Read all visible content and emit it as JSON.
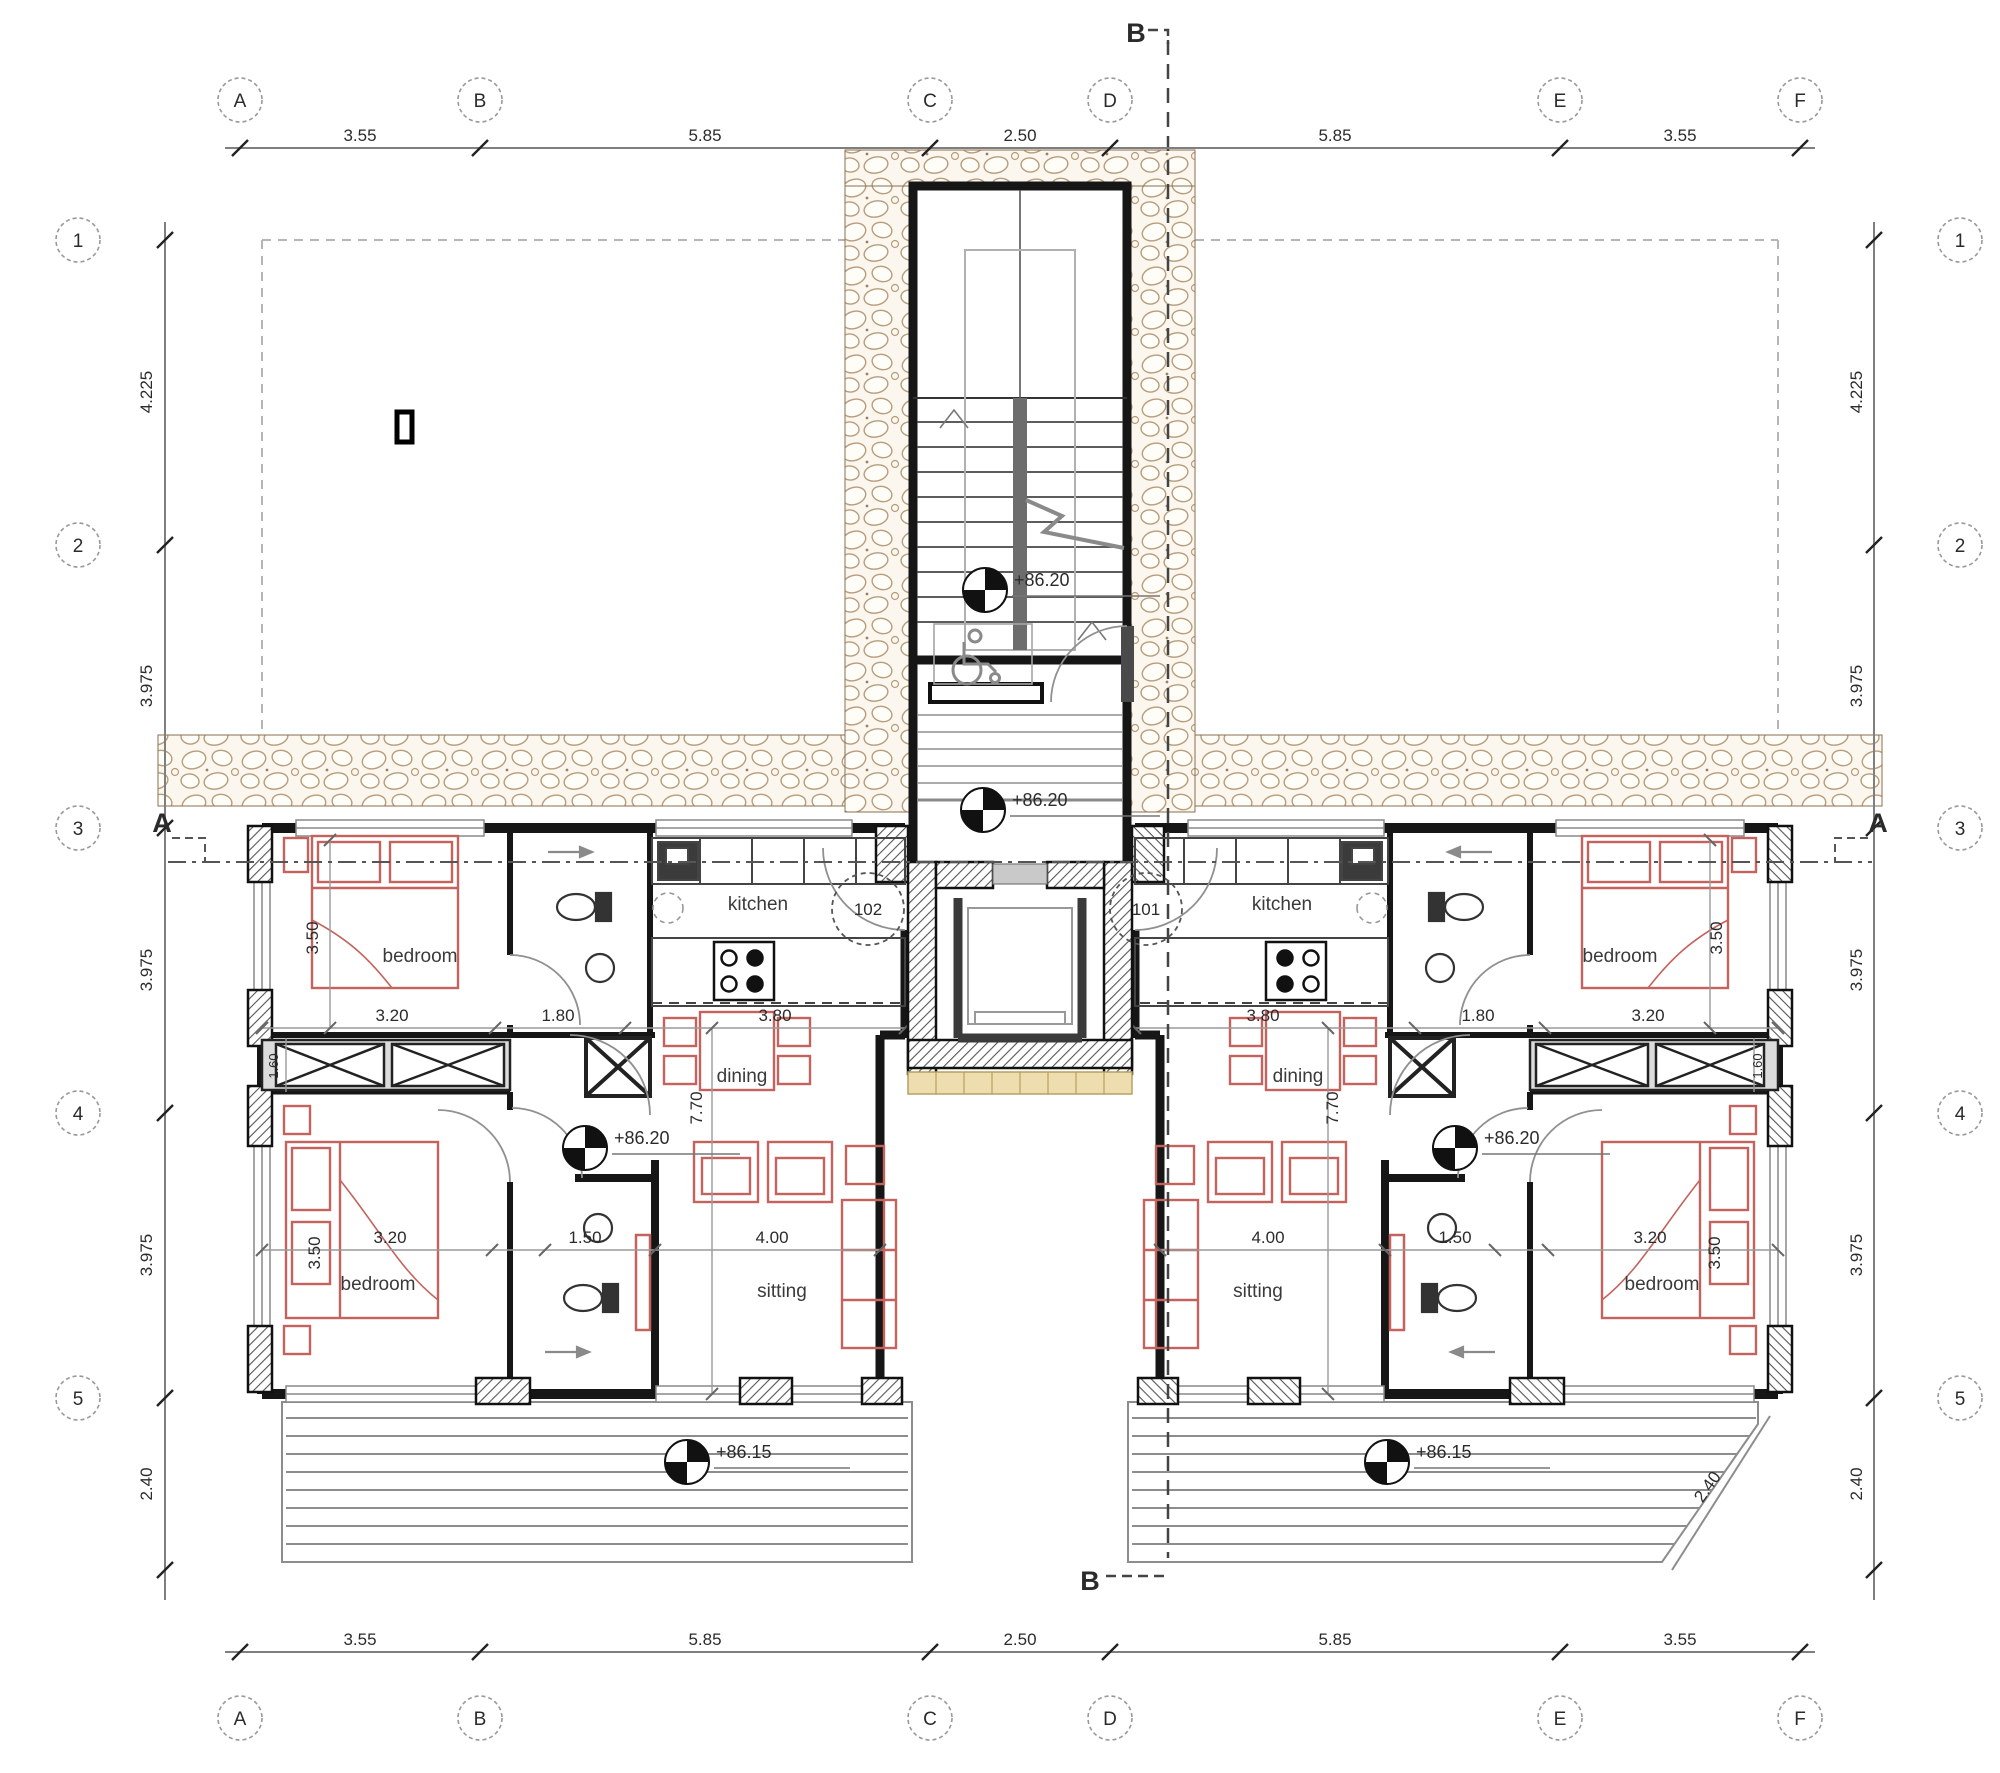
{
  "drawing": {
    "grid": {
      "cols": [
        "A",
        "B",
        "C",
        "D",
        "E",
        "F"
      ],
      "rows": [
        "1",
        "2",
        "3",
        "4",
        "5"
      ],
      "col_dims": [
        "3.55",
        "5.85",
        "2.50",
        "5.85",
        "3.55"
      ],
      "row_dims": [
        "4.225",
        "3.975",
        "3.975",
        "3.975",
        "2.40"
      ]
    },
    "section_labels": {
      "a": "A",
      "b": "B"
    },
    "units": {
      "left_number": "102",
      "right_number": "101"
    },
    "rooms": {
      "kitchen": "kitchen",
      "dining": "dining",
      "sitting": "sitting",
      "bedroom": "bedroom"
    },
    "levels": {
      "stair_landing": "+86.20",
      "entrance_hall": "+86.20",
      "apartment_floor": "+86.20",
      "terrace": "+86.15"
    },
    "dims": {
      "d160": "1.60",
      "d150": "1.50",
      "d180": "1.80",
      "d240": "2.40",
      "d320": "3.20",
      "d350": "3.50",
      "d380": "3.80",
      "d400": "4.00",
      "d770": "7.70"
    }
  },
  "colors": {
    "wall": "#161616",
    "partition": "#262626",
    "furniture_red": "#c4635e",
    "stone_outline": "#b89d7c",
    "glazing": "#eeddae",
    "grey": "#9a9a9a",
    "dim": "#333333"
  }
}
